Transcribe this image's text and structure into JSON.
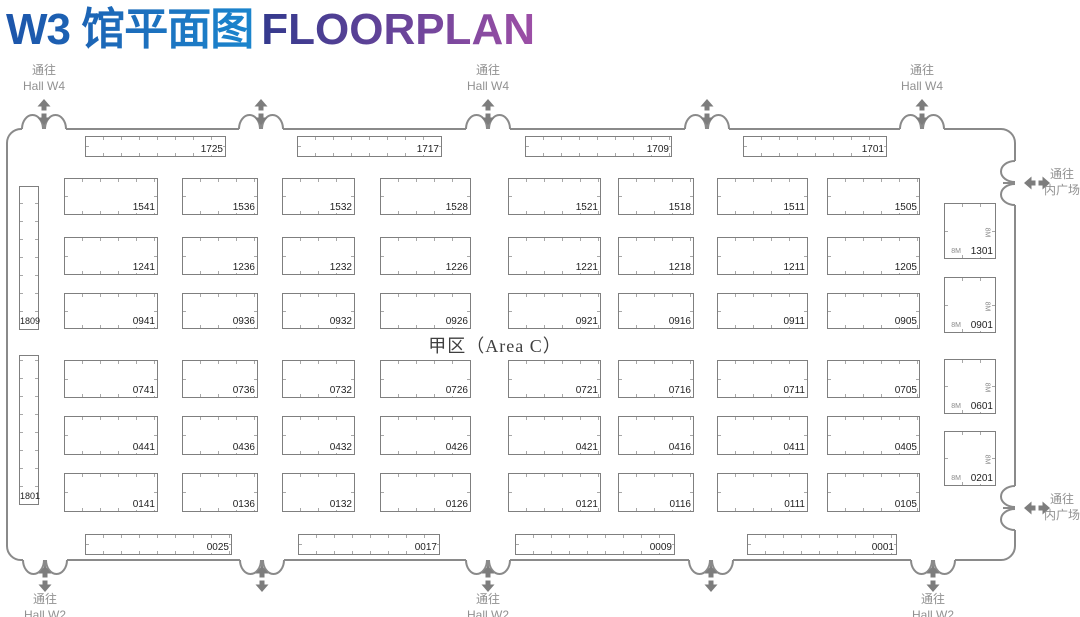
{
  "title": {
    "zh": "W3 馆平面图",
    "en": "FLOORPLAN"
  },
  "area_label": "甲区（Area C）",
  "dimension_label": "8M",
  "exit_labels": {
    "top": {
      "line1": "通往",
      "line2": "Hall W4"
    },
    "bottom": {
      "line1": "通往",
      "line2": "Hall W2"
    },
    "right": {
      "line1": "通往",
      "line2": "内广场"
    }
  },
  "doors": {
    "top": [
      {
        "x": 44,
        "labeled": true
      },
      {
        "x": 261,
        "labeled": false
      },
      {
        "x": 488,
        "labeled": true
      },
      {
        "x": 707,
        "labeled": false
      },
      {
        "x": 922,
        "labeled": true
      }
    ],
    "bottom": [
      {
        "x": 45,
        "labeled": true
      },
      {
        "x": 262,
        "labeled": false
      },
      {
        "x": 488,
        "labeled": true
      },
      {
        "x": 711,
        "labeled": false
      },
      {
        "x": 933,
        "labeled": true
      }
    ],
    "right": [
      {
        "y": 183
      },
      {
        "y": 508
      }
    ]
  },
  "grid": {
    "columns": [
      {
        "x": 64,
        "w": 94
      },
      {
        "x": 182,
        "w": 76
      },
      {
        "x": 282,
        "w": 73
      },
      {
        "x": 380,
        "w": 91
      },
      {
        "x": 508,
        "w": 93
      },
      {
        "x": 618,
        "w": 76
      },
      {
        "x": 717,
        "w": 91
      },
      {
        "x": 827,
        "w": 93
      }
    ],
    "rows": [
      {
        "y": 178,
        "h": 37,
        "ids": [
          "1541",
          "1536",
          "1532",
          "1528",
          "1521",
          "1518",
          "1511",
          "1505"
        ]
      },
      {
        "y": 237,
        "h": 38,
        "ids": [
          "1241",
          "1236",
          "1232",
          "1226",
          "1221",
          "1218",
          "1211",
          "1205"
        ]
      },
      {
        "y": 293,
        "h": 36,
        "ids": [
          "0941",
          "0936",
          "0932",
          "0926",
          "0921",
          "0916",
          "0911",
          "0905"
        ]
      },
      {
        "y": 360,
        "h": 38,
        "ids": [
          "0741",
          "0736",
          "0732",
          "0726",
          "0721",
          "0716",
          "0711",
          "0705"
        ]
      },
      {
        "y": 416,
        "h": 39,
        "ids": [
          "0441",
          "0436",
          "0432",
          "0426",
          "0421",
          "0416",
          "0411",
          "0405"
        ]
      },
      {
        "y": 473,
        "h": 39,
        "ids": [
          "0141",
          "0136",
          "0132",
          "0126",
          "0121",
          "0116",
          "0111",
          "0105"
        ]
      }
    ]
  },
  "perimeter_top": {
    "y": 136,
    "h": 21,
    "booths": [
      {
        "id": "1725",
        "x": 85,
        "w": 141
      },
      {
        "id": "1717",
        "x": 297,
        "w": 145
      },
      {
        "id": "1709",
        "x": 525,
        "w": 147
      },
      {
        "id": "1701",
        "x": 743,
        "w": 144
      }
    ]
  },
  "perimeter_bottom": {
    "y": 534,
    "h": 21,
    "booths": [
      {
        "id": "0025",
        "x": 85,
        "w": 147
      },
      {
        "id": "0017",
        "x": 298,
        "w": 142
      },
      {
        "id": "0009",
        "x": 515,
        "w": 160
      },
      {
        "id": "0001",
        "x": 747,
        "w": 150
      }
    ]
  },
  "left_booths": {
    "x": 19,
    "w": 20,
    "booths": [
      {
        "id": "1809",
        "y": 186,
        "h": 144
      },
      {
        "id": "1801",
        "y": 355,
        "h": 150
      }
    ]
  },
  "right_booths": {
    "x": 944,
    "w": 52,
    "booths": [
      {
        "id": "1301",
        "y": 203,
        "h": 56
      },
      {
        "id": "0901",
        "y": 277,
        "h": 56
      },
      {
        "id": "0601",
        "y": 359,
        "h": 55
      },
      {
        "id": "0201",
        "y": 431,
        "h": 55
      }
    ]
  },
  "colors": {
    "title_zh_gradient": [
      "#1d55aa",
      "#1b85cd"
    ],
    "title_en_gradient": [
      "#33398d",
      "#9d4fa6"
    ],
    "wall": "#8a8a8a",
    "booth_border": "#7f7f7f",
    "tick": "#a8a8a8",
    "booth_number": "#1f1f1f",
    "exit_text": "#919191",
    "arrow": "#7d7d7d",
    "area_text": "#3f3f3f"
  }
}
